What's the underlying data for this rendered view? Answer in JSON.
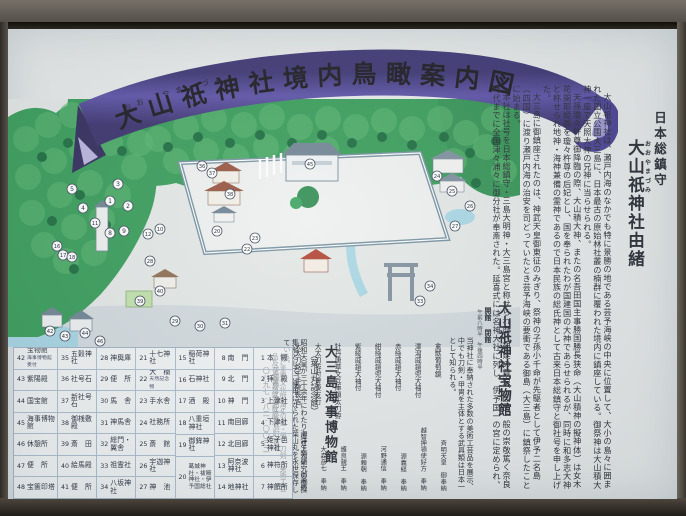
{
  "banner": {
    "title": "大山祇神社境内鳥瞰案内図",
    "furigana": "おお　やま　づみ"
  },
  "yuisho": {
    "header_small": "日本総鎮守",
    "title_ruby_base": "大山祇",
    "title_ruby_text": "おおやまづみ",
    "title_rest": "神社由緒",
    "paragraphs": [
      "大山祇神社は、瀬戸内海のなかでも特に景勝の地である芸予海峡の中央に位置して、大小の島々に囲まれた国立公園大三島に、日本最古の原始林社叢の楠群に覆われた境内に鎮座している。御祭神は大山積大神一座で天照大神の兄神に当らせられる。",
      "天孫瓊々杵尊御降臨の際、大山積大神、またの名吾田国主事勝国勝長狭命（大山積神の擬神体）は女木花開耶姫尊を瓊々杵尊の后妃とし、国を奉られたわが国建国の大神であらせられるが、同時に和多志大神と称せられ地神・海神兼備の霊神であるので日本民族の総氏神として古来日本総鎮守と御社号を申し上げた。",
      "大三島に御鎮座されたのは、神武天皇御東征のみぎり、祭神の子孫小千命が先駆者として伊予二名島（四国）に渡り瀬戸内海の治安を司どっていたとき芸予海峡の要衝である御島（大三島）に鎮祭したことに始まる。",
      "本社は社号を日本総鎮守・三島大明神・大三島宮と称せられ歴代朝廷の尊崇、国民一般の崇敬篤く奈良時代までに全国津々浦々に御分社が奉斎された。延喜式には名神大社に列し、伊予国一の宮に定められ、官制に依り国幣大社に列せられた四国唯一の大社である。現在官制は廃せられたが、地神・海神兼備の大霊神として千古の昔に変わらぬ崇敬を寄せられ、全国に奉斎される大山祇神社・三島神社の総本社として、又数万点に及ぶ宝物類を蔵する国宝の島として四季を通して多数の参拝者で賑わっている。"
    ]
  },
  "homotsukan": {
    "title": "大山祇神社宝物館",
    "open_label": "開館",
    "close_label": "閉館",
    "hours_note": "午前八時半　午後四時半",
    "intro": "当神社に奉納された多数の美術工芸品を展示、中でも刀剣・甲冑を主体とする武具類は日本一として知られる。",
    "treasures": [
      {
        "name": "禽獣葡萄鏡",
        "donor": "斉明天皇　御奉納"
      },
      {
        "name": "澤瀉威鎧兜大袖付",
        "donor": "越智押領使好方　奉納"
      },
      {
        "name": "赤絲威鎧大袖付",
        "donor": "源義経　奉納"
      },
      {
        "name": "紺絲威鎧兜大袖付",
        "donor": "河野通信　奉納"
      },
      {
        "name": "紫綾威鎧大袖付",
        "donor": "源頼朝　奉納"
      },
      {
        "name": "牡丹唐草文兵庫鎖太刀拵",
        "donor": "護良親王　奉納"
      },
      {
        "name": "大太刀拵付豊後友行",
        "donor": "大森彦七　奉納"
      },
      {
        "name": "大太刀銘千手院長吉",
        "donor": "後村上天皇　御奉納"
      }
    ],
    "note": "他に重要文化財指定の鎧・兜・刀剣・美術工芸品及び文書類等多数展示"
  },
  "museum": {
    "title": "大三島海事博物館",
    "subtitle": "（葉山丸記念館）",
    "desc": "昭和天皇が三十余年にわたり海洋生物研究の御採集船としてご使用になられた葉山丸を永世保存している。",
    "address": "愛媛県今治市大三島町宮浦",
    "phone": "〇八九七-八二-〇〇三二"
  },
  "legend": {
    "columns": [
      {
        "items": [
          {
            "no": "42",
            "label": "宝物館",
            "sub": "海事博物館 受付"
          },
          {
            "no": "43",
            "label": "紫陽殿"
          },
          {
            "no": "44",
            "label": "国宝館"
          },
          {
            "no": "45",
            "label": "海事博物館"
          },
          {
            "no": "46",
            "label": "休憩所"
          },
          {
            "no": "47",
            "label": "便　所"
          },
          {
            "no": "48",
            "label": "宝篋印塔"
          }
        ]
      },
      {
        "items": [
          {
            "no": "35",
            "label": "五穀神社"
          },
          {
            "no": "36",
            "label": "社号石"
          },
          {
            "no": "37",
            "label": "新社号石"
          },
          {
            "no": "38",
            "label": "御桟敷殿"
          },
          {
            "no": "39",
            "label": "斎　田"
          },
          {
            "no": "40",
            "label": "絵馬殿"
          },
          {
            "no": "41",
            "label": "便　所"
          }
        ]
      },
      {
        "items": [
          {
            "no": "28",
            "label": "神輿庫"
          },
          {
            "no": "29",
            "label": "便　所"
          },
          {
            "no": "30",
            "label": "馬　舎"
          },
          {
            "no": "31",
            "label": "神馬舎"
          },
          {
            "no": "32",
            "label": "総門・翼舎"
          },
          {
            "no": "33",
            "label": "祖霊社"
          },
          {
            "no": "34",
            "label": "八坂神社"
          }
        ]
      },
      {
        "items": [
          {
            "no": "21",
            "label": "十七神社"
          },
          {
            "no": "22",
            "label": "大　楠",
            "sub": "天然記念物"
          },
          {
            "no": "23",
            "label": "手水舎"
          },
          {
            "no": "24",
            "label": "社務所"
          },
          {
            "no": "25",
            "label": "斎　館"
          },
          {
            "no": "26",
            "label": "宇迦神社"
          },
          {
            "no": "27",
            "label": "神　池"
          }
        ]
      },
      {
        "items": [
          {
            "no": "15",
            "label": "稲荷神社"
          },
          {
            "no": "16",
            "label": "石神社"
          },
          {
            "no": "17",
            "label": "酒　殿"
          },
          {
            "no": "18",
            "label": "八重垣神社"
          },
          {
            "no": "19",
            "label": "御鉾神社"
          },
          {
            "no": "20",
            "label": "葛城神社・祓殿神社・伊予国総社",
            "tall": true
          }
        ]
      },
      {
        "items": [
          {
            "no": "8",
            "label": "南　門"
          },
          {
            "no": "9",
            "label": "北　門"
          },
          {
            "no": "10",
            "label": "神　門"
          },
          {
            "no": "11",
            "label": "南回廊"
          },
          {
            "no": "12",
            "label": "北回廊"
          },
          {
            "no": "13",
            "label": "阿奈波神社"
          },
          {
            "no": "14",
            "label": "地神社"
          }
        ]
      },
      {
        "items": [
          {
            "no": "1",
            "label": "本　殿"
          },
          {
            "no": "2",
            "label": "拝　殿"
          },
          {
            "no": "3",
            "label": "上津社"
          },
          {
            "no": "4",
            "label": "下津社"
          },
          {
            "no": "5",
            "label": "姫子邑神社"
          },
          {
            "no": "6",
            "label": "神符所"
          },
          {
            "no": "7",
            "label": "神饌所"
          }
        ]
      }
    ]
  },
  "map": {
    "markers": [
      {
        "n": "1",
        "x": 102,
        "y": 102
      },
      {
        "n": "2",
        "x": 120,
        "y": 107
      },
      {
        "n": "3",
        "x": 110,
        "y": 85
      },
      {
        "n": "4",
        "x": 75,
        "y": 109
      },
      {
        "n": "5",
        "x": 64,
        "y": 90
      },
      {
        "n": "8",
        "x": 102,
        "y": 134
      },
      {
        "n": "9",
        "x": 116,
        "y": 132
      },
      {
        "n": "10",
        "x": 152,
        "y": 130
      },
      {
        "n": "11",
        "x": 87,
        "y": 124
      },
      {
        "n": "12",
        "x": 140,
        "y": 135
      },
      {
        "n": "16",
        "x": 49,
        "y": 147
      },
      {
        "n": "17",
        "x": 55,
        "y": 156
      },
      {
        "n": "18",
        "x": 64,
        "y": 158
      },
      {
        "n": "20",
        "x": 209,
        "y": 132
      },
      {
        "n": "22",
        "x": 239,
        "y": 150
      },
      {
        "n": "23",
        "x": 247,
        "y": 139
      },
      {
        "n": "24",
        "x": 429,
        "y": 77
      },
      {
        "n": "25",
        "x": 444,
        "y": 92
      },
      {
        "n": "26",
        "x": 462,
        "y": 107
      },
      {
        "n": "27",
        "x": 447,
        "y": 127
      },
      {
        "n": "28",
        "x": 142,
        "y": 162
      },
      {
        "n": "29",
        "x": 167,
        "y": 222
      },
      {
        "n": "30",
        "x": 192,
        "y": 227
      },
      {
        "n": "31",
        "x": 217,
        "y": 224
      },
      {
        "n": "33",
        "x": 412,
        "y": 202
      },
      {
        "n": "34",
        "x": 422,
        "y": 187
      },
      {
        "n": "36",
        "x": 194,
        "y": 67
      },
      {
        "n": "37",
        "x": 204,
        "y": 74
      },
      {
        "n": "38",
        "x": 222,
        "y": 95
      },
      {
        "n": "39",
        "x": 132,
        "y": 202
      },
      {
        "n": "40",
        "x": 152,
        "y": 192
      },
      {
        "n": "42",
        "x": 42,
        "y": 232
      },
      {
        "n": "43",
        "x": 57,
        "y": 237
      },
      {
        "n": "44",
        "x": 77,
        "y": 234
      },
      {
        "n": "45",
        "x": 302,
        "y": 65
      },
      {
        "n": "46",
        "x": 92,
        "y": 242
      }
    ]
  },
  "colors": {
    "hill_green": "#339a55",
    "bump_green": "#5cb96e",
    "tree_green": "#16693a",
    "ribbon_purple": "#453c8e",
    "water_blue": "#a8d6e4",
    "roof_red": "#96503c",
    "roof_gray": "#6d8190",
    "board_bg": "#e6e9e8"
  }
}
